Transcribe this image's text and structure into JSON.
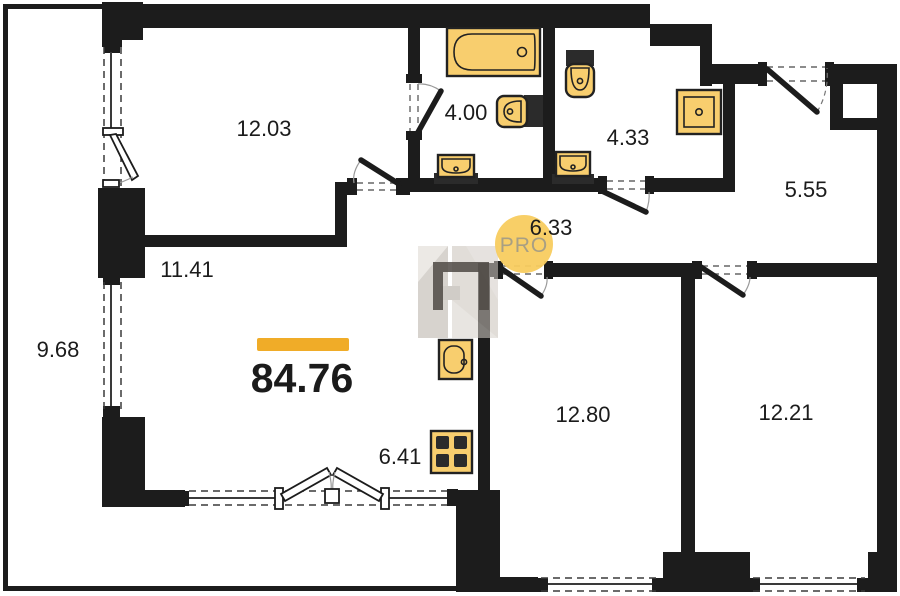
{
  "plan": {
    "title": "apartment-floor-plan",
    "total_area": "84.76",
    "badge": {
      "text": "PRO"
    },
    "rooms": [
      {
        "id": "room-12-03",
        "area": "12.03"
      },
      {
        "id": "bathroom-4-00",
        "area": "4.00"
      },
      {
        "id": "bathroom-4-33",
        "area": "4.33"
      },
      {
        "id": "hall-5-55",
        "area": "5.55"
      },
      {
        "id": "corridor-6-33",
        "area": "6.33"
      },
      {
        "id": "hallway-11-41",
        "area": "11.41"
      },
      {
        "id": "balcony-9-68",
        "area": "9.68"
      },
      {
        "id": "kitchen-6-41",
        "area": "6.41"
      },
      {
        "id": "room-12-80",
        "area": "12.80"
      },
      {
        "id": "room-12-21",
        "area": "12.21"
      }
    ],
    "fixtures": [
      "bathtub-icon",
      "toilet-icon",
      "sink-icon",
      "shower-icon",
      "kitchen-sink-icon",
      "stove-icon"
    ],
    "colors": {
      "wall_black": "#1c1c1c",
      "fixture_yellow": "#f8ce6e",
      "bar_yellow": "#f0ac28",
      "badge_yellow": "#f8cc5f",
      "badge_text": "#a89f83"
    }
  }
}
